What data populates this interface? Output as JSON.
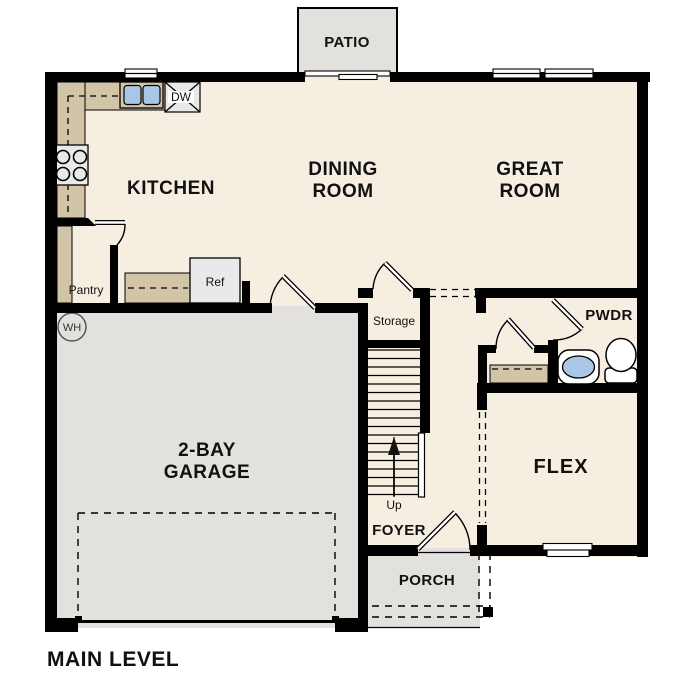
{
  "plan_title": "MAIN LEVEL",
  "rooms": {
    "patio": {
      "label": "PATIO"
    },
    "kitchen": {
      "label": "KITCHEN"
    },
    "dining": {
      "line1": "DINING",
      "line2": "ROOM"
    },
    "great": {
      "line1": "GREAT",
      "line2": "ROOM"
    },
    "pantry": {
      "label": "Pantry"
    },
    "garage": {
      "line1": "2-BAY",
      "line2": "GARAGE"
    },
    "storage": {
      "label": "Storage"
    },
    "foyer": {
      "label": "FOYER"
    },
    "porch": {
      "label": "PORCH"
    },
    "flex": {
      "label": "FLEX"
    },
    "pwdr": {
      "label": "PWDR"
    }
  },
  "fixtures": {
    "dishwasher_label": "DW",
    "refrigerator_label": "Ref",
    "water_heater_label": "WH",
    "stairs_direction_label": "Up"
  },
  "colors": {
    "floor": "#f6efe1",
    "garage": "#e3e1dd",
    "counter": "#d1c4a7",
    "sink_blue": "#a9c7e5",
    "appliance": "#e9e9e9",
    "wall": "#000000",
    "label_plate": "#ffffff"
  }
}
